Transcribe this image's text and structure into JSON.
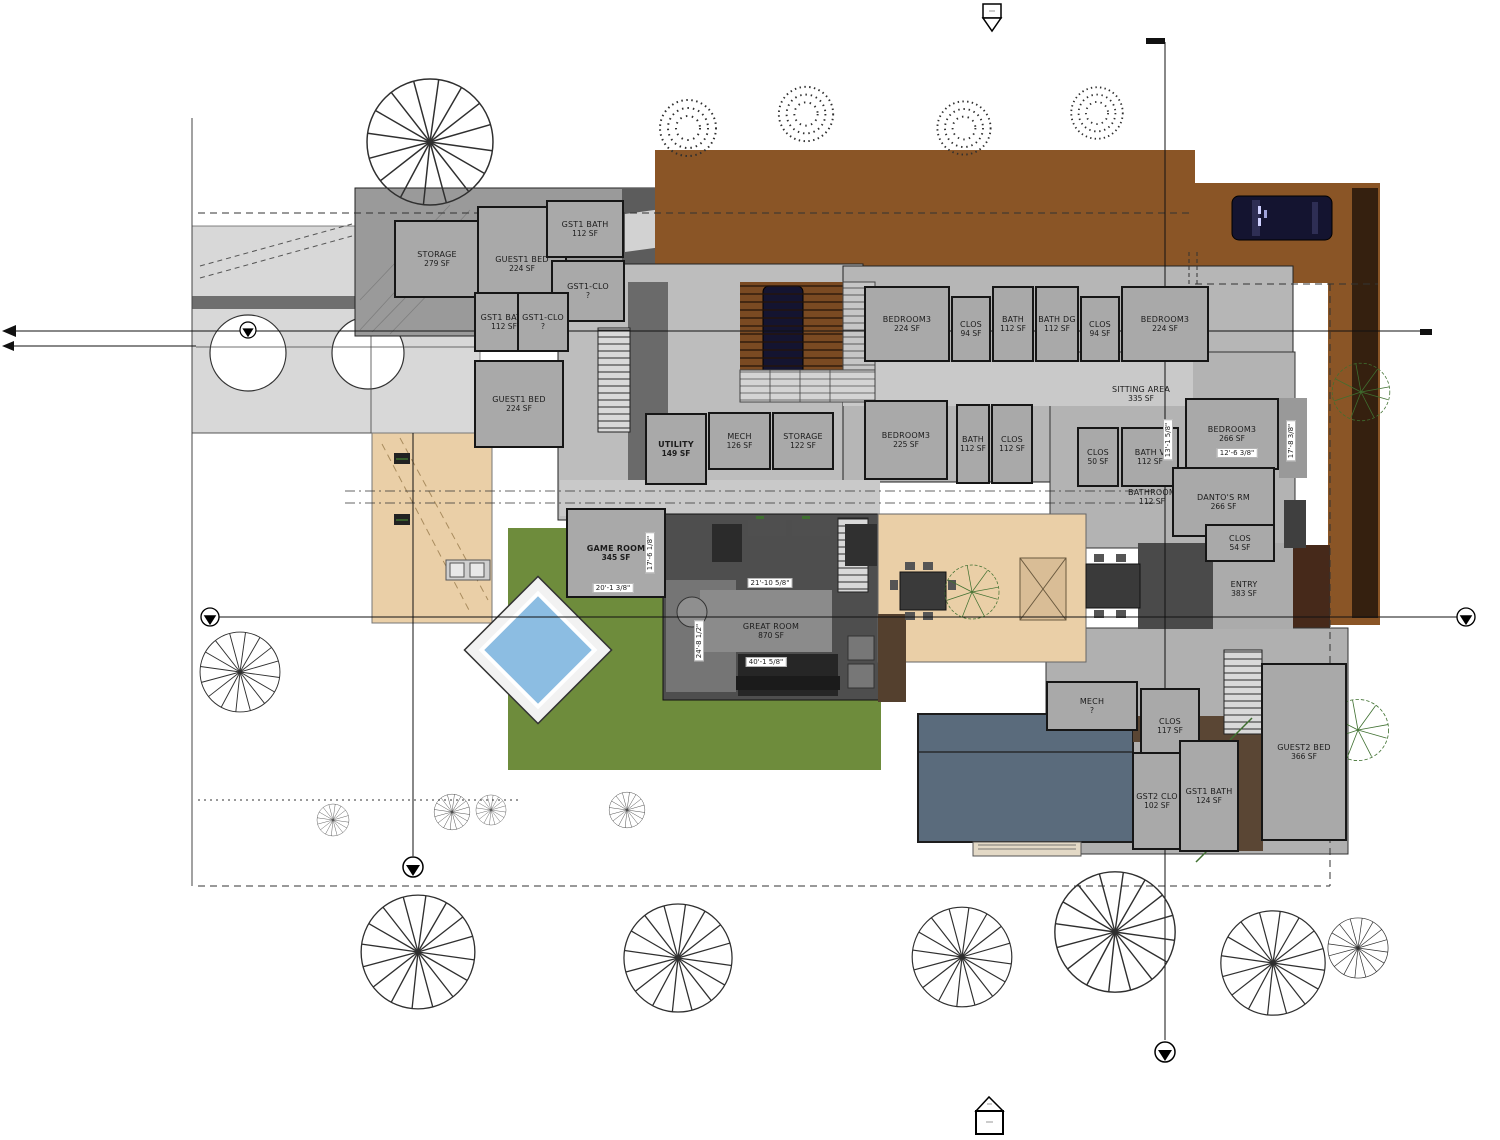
{
  "drawing": {
    "kind_label": "residential floor / site plan",
    "colors": {
      "paper": "#ffffff",
      "roomFill": "#a9a9a9",
      "roomBorder": "#161616",
      "ink": "#1c1c1c",
      "dirt": "#8a5526",
      "dirtDark": "#35200f",
      "brownPatch": "#46291a",
      "woodFloor": "#5a4634",
      "lawn": "#6e8c3c",
      "pool": "#8cbde2",
      "slate": "#5a6b7c",
      "patio": "#eacfa7",
      "driveway": "#d8d8d8",
      "roadBand": "#6f6f6f",
      "roofDark": "#5c5c5c",
      "baseGray": "#bdbdbd",
      "hallGray": "#c9c9c9",
      "greatRoomDark": "#4e4e4e",
      "carNavy": "#141430",
      "treeStroke": "#2f2f2f",
      "greenTree": "#3f7030",
      "pergola": "#7a4a22"
    }
  },
  "rooms": [
    {
      "name": "STORAGE",
      "area": "279 SF",
      "x": 394,
      "y": 220,
      "w": 86,
      "h": 78
    },
    {
      "name": "GUEST1 BED",
      "area": "224 SF",
      "x": 477,
      "y": 206,
      "w": 90,
      "h": 116
    },
    {
      "name": "GST1 BATH",
      "area": "112 SF",
      "x": 546,
      "y": 200,
      "w": 78,
      "h": 58
    },
    {
      "name": "GST1-CLO",
      "area": "?",
      "x": 551,
      "y": 260,
      "w": 74,
      "h": 62
    },
    {
      "name": "GST1 BATH",
      "area": "112 SF",
      "x": 474,
      "y": 292,
      "w": 60,
      "h": 60
    },
    {
      "name": "GST1-CLO",
      "area": "?",
      "x": 517,
      "y": 292,
      "w": 52,
      "h": 60
    },
    {
      "name": "GUEST1 BED",
      "area": "224 SF",
      "x": 474,
      "y": 360,
      "w": 90,
      "h": 88
    },
    {
      "name": "UTILITY",
      "area": "149 SF",
      "x": 645,
      "y": 413,
      "w": 62,
      "h": 72,
      "bold": true
    },
    {
      "name": "MECH",
      "area": "126 SF",
      "x": 708,
      "y": 412,
      "w": 63,
      "h": 58
    },
    {
      "name": "STORAGE",
      "area": "122 SF",
      "x": 772,
      "y": 412,
      "w": 62,
      "h": 58
    },
    {
      "name": "BEDROOM3",
      "area": "224 SF",
      "x": 864,
      "y": 286,
      "w": 86,
      "h": 76
    },
    {
      "name": "CLOS",
      "area": "94 SF",
      "x": 951,
      "y": 296,
      "w": 40,
      "h": 66
    },
    {
      "name": "BATH",
      "area": "112 SF",
      "x": 992,
      "y": 286,
      "w": 42,
      "h": 76
    },
    {
      "name": "BATH DG",
      "area": "112 SF",
      "x": 1035,
      "y": 286,
      "w": 44,
      "h": 76
    },
    {
      "name": "CLOS",
      "area": "94 SF",
      "x": 1080,
      "y": 296,
      "w": 40,
      "h": 66
    },
    {
      "name": "BEDROOM3",
      "area": "224 SF",
      "x": 1121,
      "y": 286,
      "w": 88,
      "h": 76
    },
    {
      "name": "BEDROOM3",
      "area": "225 SF",
      "x": 864,
      "y": 400,
      "w": 84,
      "h": 80
    },
    {
      "name": "BATH",
      "area": "112 SF",
      "x": 956,
      "y": 404,
      "w": 34,
      "h": 80
    },
    {
      "name": "CLOS",
      "area": "112 SF",
      "x": 991,
      "y": 404,
      "w": 42,
      "h": 80
    },
    {
      "name": "SITTING AREA",
      "area": "335 SF",
      "x": 1075,
      "y": 372,
      "w": 132,
      "h": 44,
      "noborder": true
    },
    {
      "name": "CLOS",
      "area": "50 SF",
      "x": 1077,
      "y": 427,
      "w": 42,
      "h": 60
    },
    {
      "name": "BATH V",
      "area": "112 SF",
      "x": 1121,
      "y": 427,
      "w": 58,
      "h": 60
    },
    {
      "name": "BEDROOM3",
      "area": "266 SF",
      "x": 1185,
      "y": 398,
      "w": 94,
      "h": 72
    },
    {
      "name": "BATHROOM",
      "area": "112 SF",
      "x": 1108,
      "y": 477,
      "w": 88,
      "h": 40,
      "noborder": true
    },
    {
      "name": "DANTO'S RM",
      "area": "266 SF",
      "x": 1172,
      "y": 467,
      "w": 103,
      "h": 70
    },
    {
      "name": "CLOS",
      "area": "54 SF",
      "x": 1205,
      "y": 524,
      "w": 70,
      "h": 38
    },
    {
      "name": "ENTRY",
      "area": "383 SF",
      "x": 1198,
      "y": 560,
      "w": 92,
      "h": 58,
      "noborder": true
    },
    {
      "name": "GAME ROOM",
      "area": "345 SF",
      "x": 566,
      "y": 508,
      "w": 100,
      "h": 90,
      "bold": true
    },
    {
      "name": "GREAT ROOM",
      "area": "870 SF",
      "x": 716,
      "y": 608,
      "w": 110,
      "h": 46,
      "noborder": true
    },
    {
      "name": "MECH",
      "area": "?",
      "x": 1046,
      "y": 681,
      "w": 92,
      "h": 50
    },
    {
      "name": "CLOS",
      "area": "117 SF",
      "x": 1140,
      "y": 688,
      "w": 60,
      "h": 76
    },
    {
      "name": "GST2 CLO",
      "area": "102 SF",
      "x": 1132,
      "y": 752,
      "w": 50,
      "h": 98
    },
    {
      "name": "GST1 BATH",
      "area": "124 SF",
      "x": 1179,
      "y": 740,
      "w": 60,
      "h": 112
    },
    {
      "name": "GUEST2 BED",
      "area": "366 SF",
      "x": 1261,
      "y": 663,
      "w": 86,
      "h": 178
    }
  ],
  "dims": [
    {
      "text": "20'-1 3/8\"",
      "x": 613,
      "y": 588,
      "rot": 0
    },
    {
      "text": "17'-6 1/8\"",
      "x": 650,
      "y": 553,
      "rot": 90
    },
    {
      "text": "21'-10 5/8\"",
      "x": 770,
      "y": 583,
      "rot": 0
    },
    {
      "text": "40'-1 5/8\"",
      "x": 766,
      "y": 662,
      "rot": 0
    },
    {
      "text": "24'-8 1/2\"",
      "x": 699,
      "y": 641,
      "rot": 90
    },
    {
      "text": "12'-6 3/8\"",
      "x": 1237,
      "y": 453,
      "rot": 0
    },
    {
      "text": "17'-8 3/8\"",
      "x": 1291,
      "y": 441,
      "rot": 90
    },
    {
      "text": "13'-1 5/8\"",
      "x": 1168,
      "y": 440,
      "rot": 90
    }
  ]
}
